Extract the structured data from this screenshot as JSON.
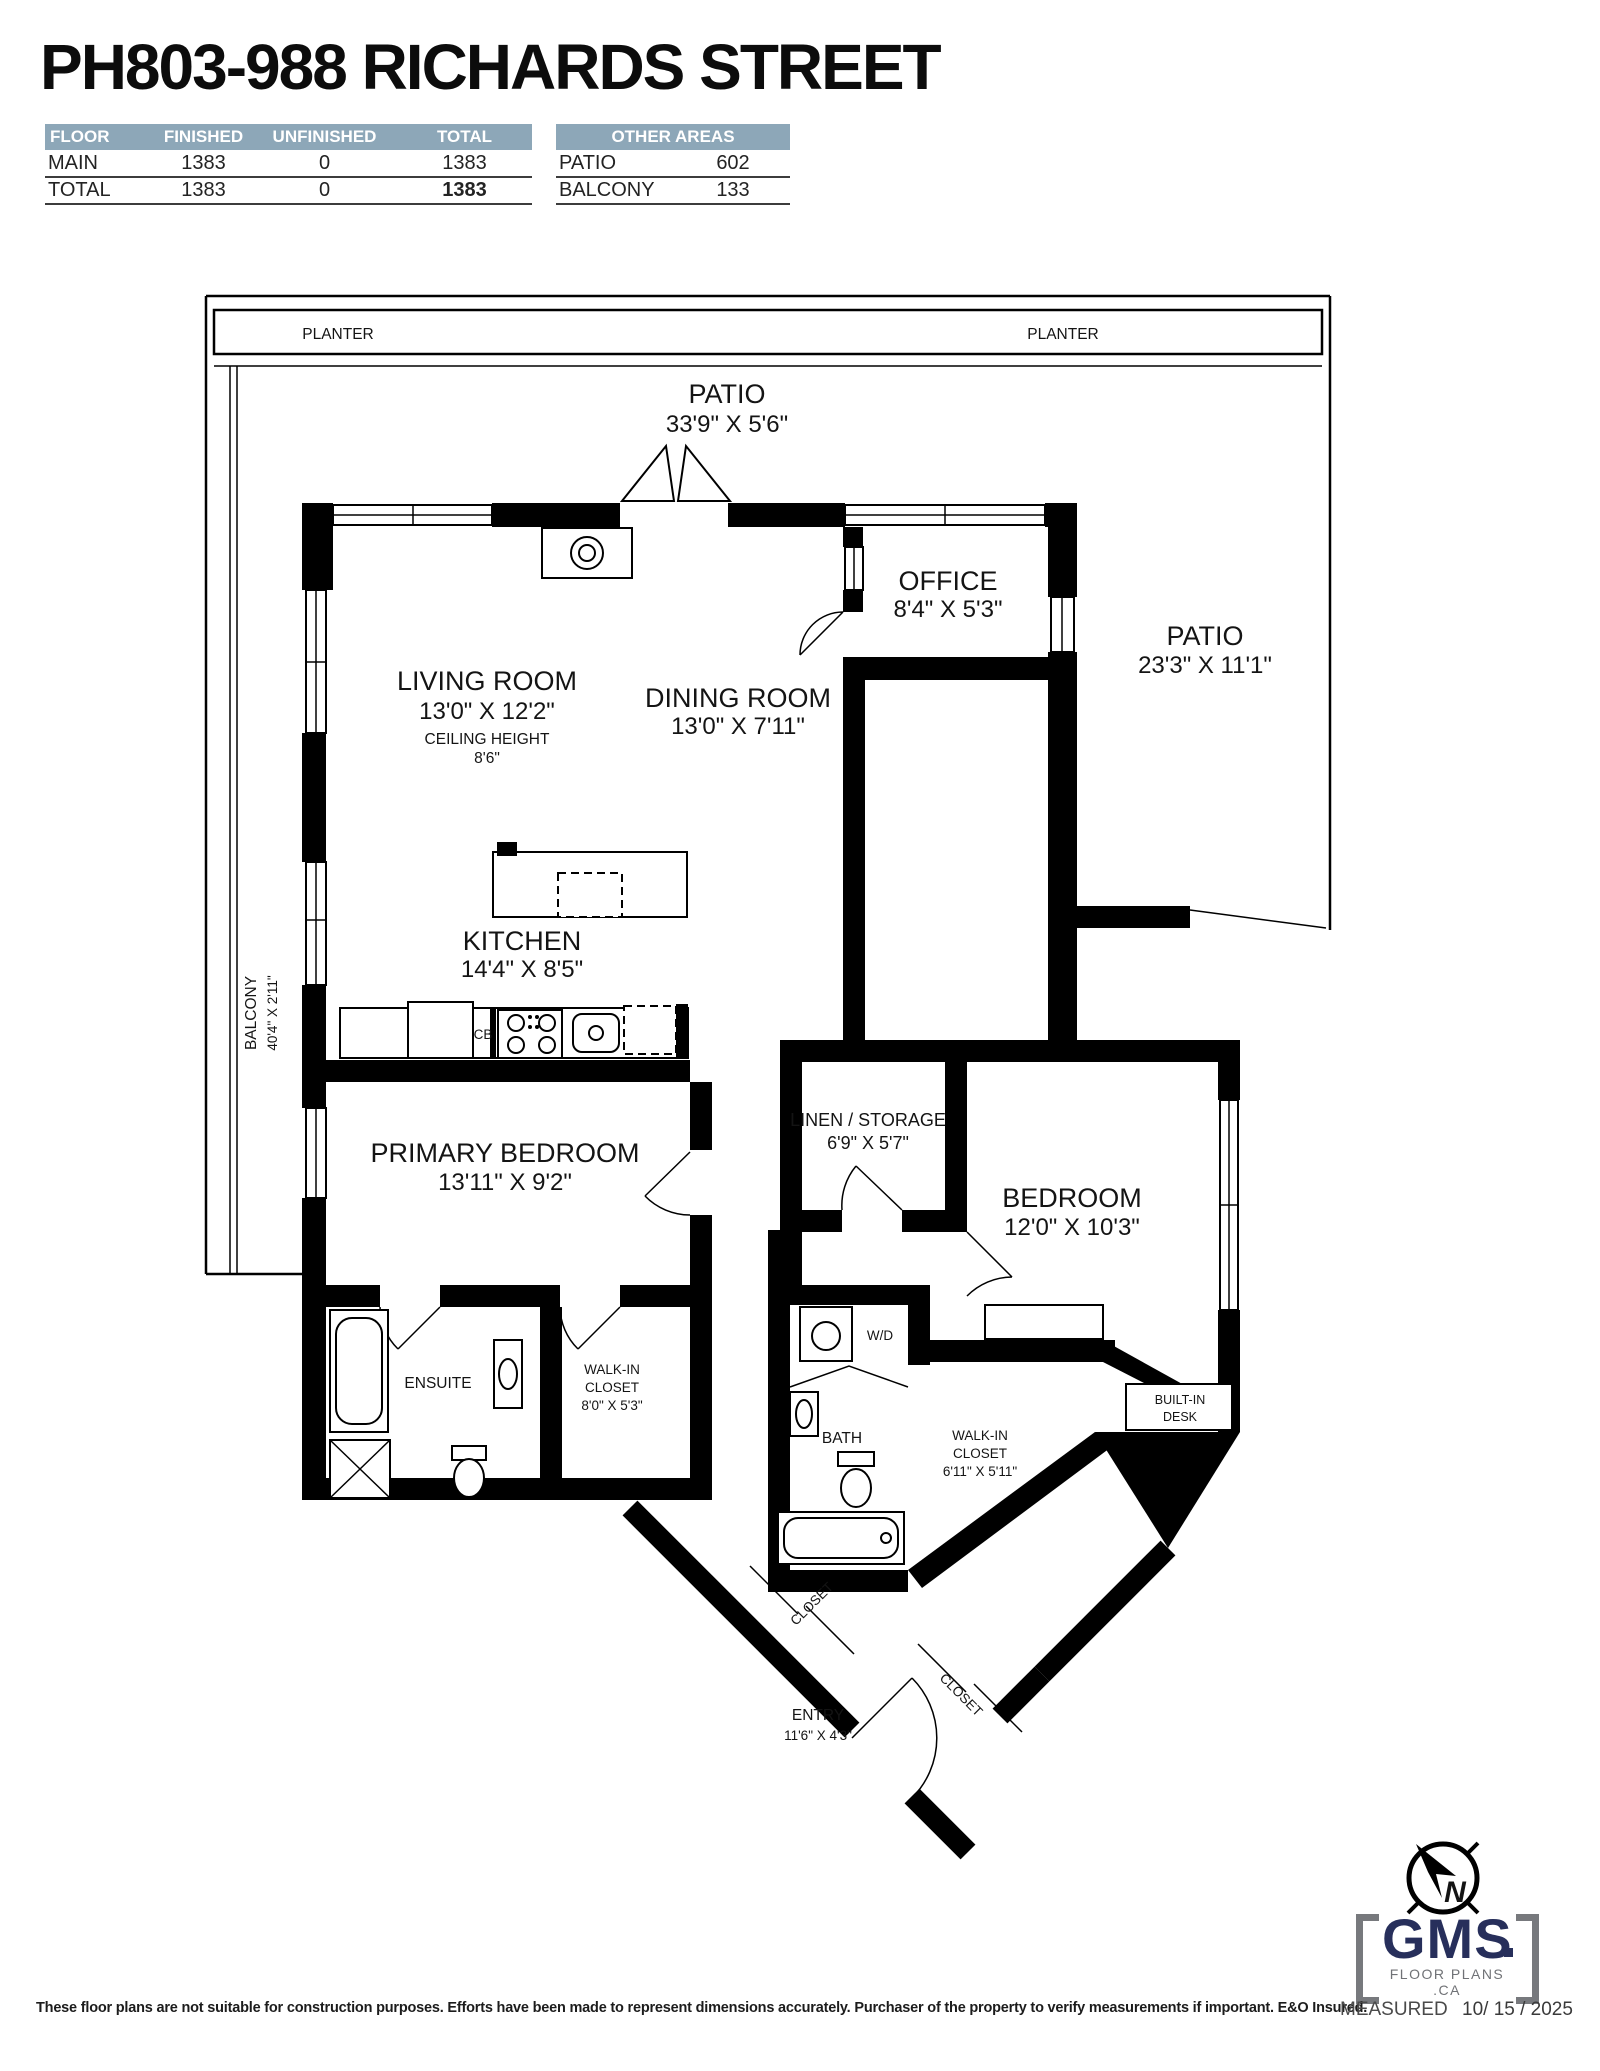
{
  "title": "PH803-988 RICHARDS STREET",
  "area_table": {
    "headers": [
      "FLOOR",
      "FINISHED",
      "UNFINISHED",
      "TOTAL"
    ],
    "rows": [
      {
        "floor": "MAIN",
        "finished": "1383",
        "unfinished": "0",
        "total": "1383"
      },
      {
        "floor": "TOTAL",
        "finished": "1383",
        "unfinished": "0",
        "total": "1383"
      }
    ]
  },
  "other_areas": {
    "header": "OTHER AREAS",
    "rows": [
      {
        "label": "PATIO",
        "value": "602"
      },
      {
        "label": "BALCONY",
        "value": "133"
      }
    ]
  },
  "plan": {
    "planter_left": "PLANTER",
    "planter_right": "PLANTER",
    "patio_top": {
      "label": "PATIO",
      "dims": "33'9\" X 5'6\""
    },
    "living_room": {
      "label": "LIVING ROOM",
      "dims": "13'0\" X 12'2\"",
      "ceiling_label": "CEILING HEIGHT",
      "ceiling_value": "8'6\""
    },
    "dining_room": {
      "label": "DINING ROOM",
      "dims": "13'0\" X 7'11\""
    },
    "office": {
      "label": "OFFICE",
      "dims": "8'4\" X 5'3\""
    },
    "patio_right": {
      "label": "PATIO",
      "dims": "23'3\" X 11'1\""
    },
    "kitchen": {
      "label": "KITCHEN",
      "dims": "14'4\" X 8'5\"",
      "cabinet": "CB"
    },
    "balcony": {
      "label": "BALCONY",
      "dims": "40'4\" X 2'11\""
    },
    "primary_bedroom": {
      "label": "PRIMARY BEDROOM",
      "dims": "13'11\" X 9'2\""
    },
    "linen": {
      "label": "LINEN / STORAGE",
      "dims": "6'9\" X 5'7\""
    },
    "bedroom": {
      "label": "BEDROOM",
      "dims": "12'0\" X 10'3\""
    },
    "ensuite": {
      "label": "ENSUITE"
    },
    "walk_in_closet_1": {
      "line1": "WALK-IN",
      "line2": "CLOSET",
      "dims": "8'0\" X 5'3\""
    },
    "bath": {
      "label": "BATH"
    },
    "laundry": {
      "label": "W/D"
    },
    "walk_in_closet_2": {
      "line1": "WALK-IN",
      "line2": "CLOSET",
      "dims": "6'11\" X 5'11\""
    },
    "built_in_desk": {
      "line1": "BUILT-IN",
      "line2": "DESK"
    },
    "closet_1": "CLOSET",
    "closet_2": "CLOSET",
    "entry": {
      "label": "ENTRY",
      "dims": "11'6\" X 4'3\""
    }
  },
  "footer": {
    "disclaimer": "These floor plans are not suitable for construction purposes. Efforts have been made to represent dimensions accurately.  Purchaser of the property to verify measurements if important.  E&O Insured.",
    "measured_label": "MEASURED",
    "measured_date": "10/ 15 / 2025"
  },
  "logo": {
    "brand": "GMS",
    "tagline": "FLOOR PLANS .CA",
    "compass_letter": "N"
  },
  "colors": {
    "table_header_bg": "#8DA7B8",
    "logo_navy": "#272F5B",
    "logo_gray": "#707276",
    "wall_black": "#000000"
  }
}
